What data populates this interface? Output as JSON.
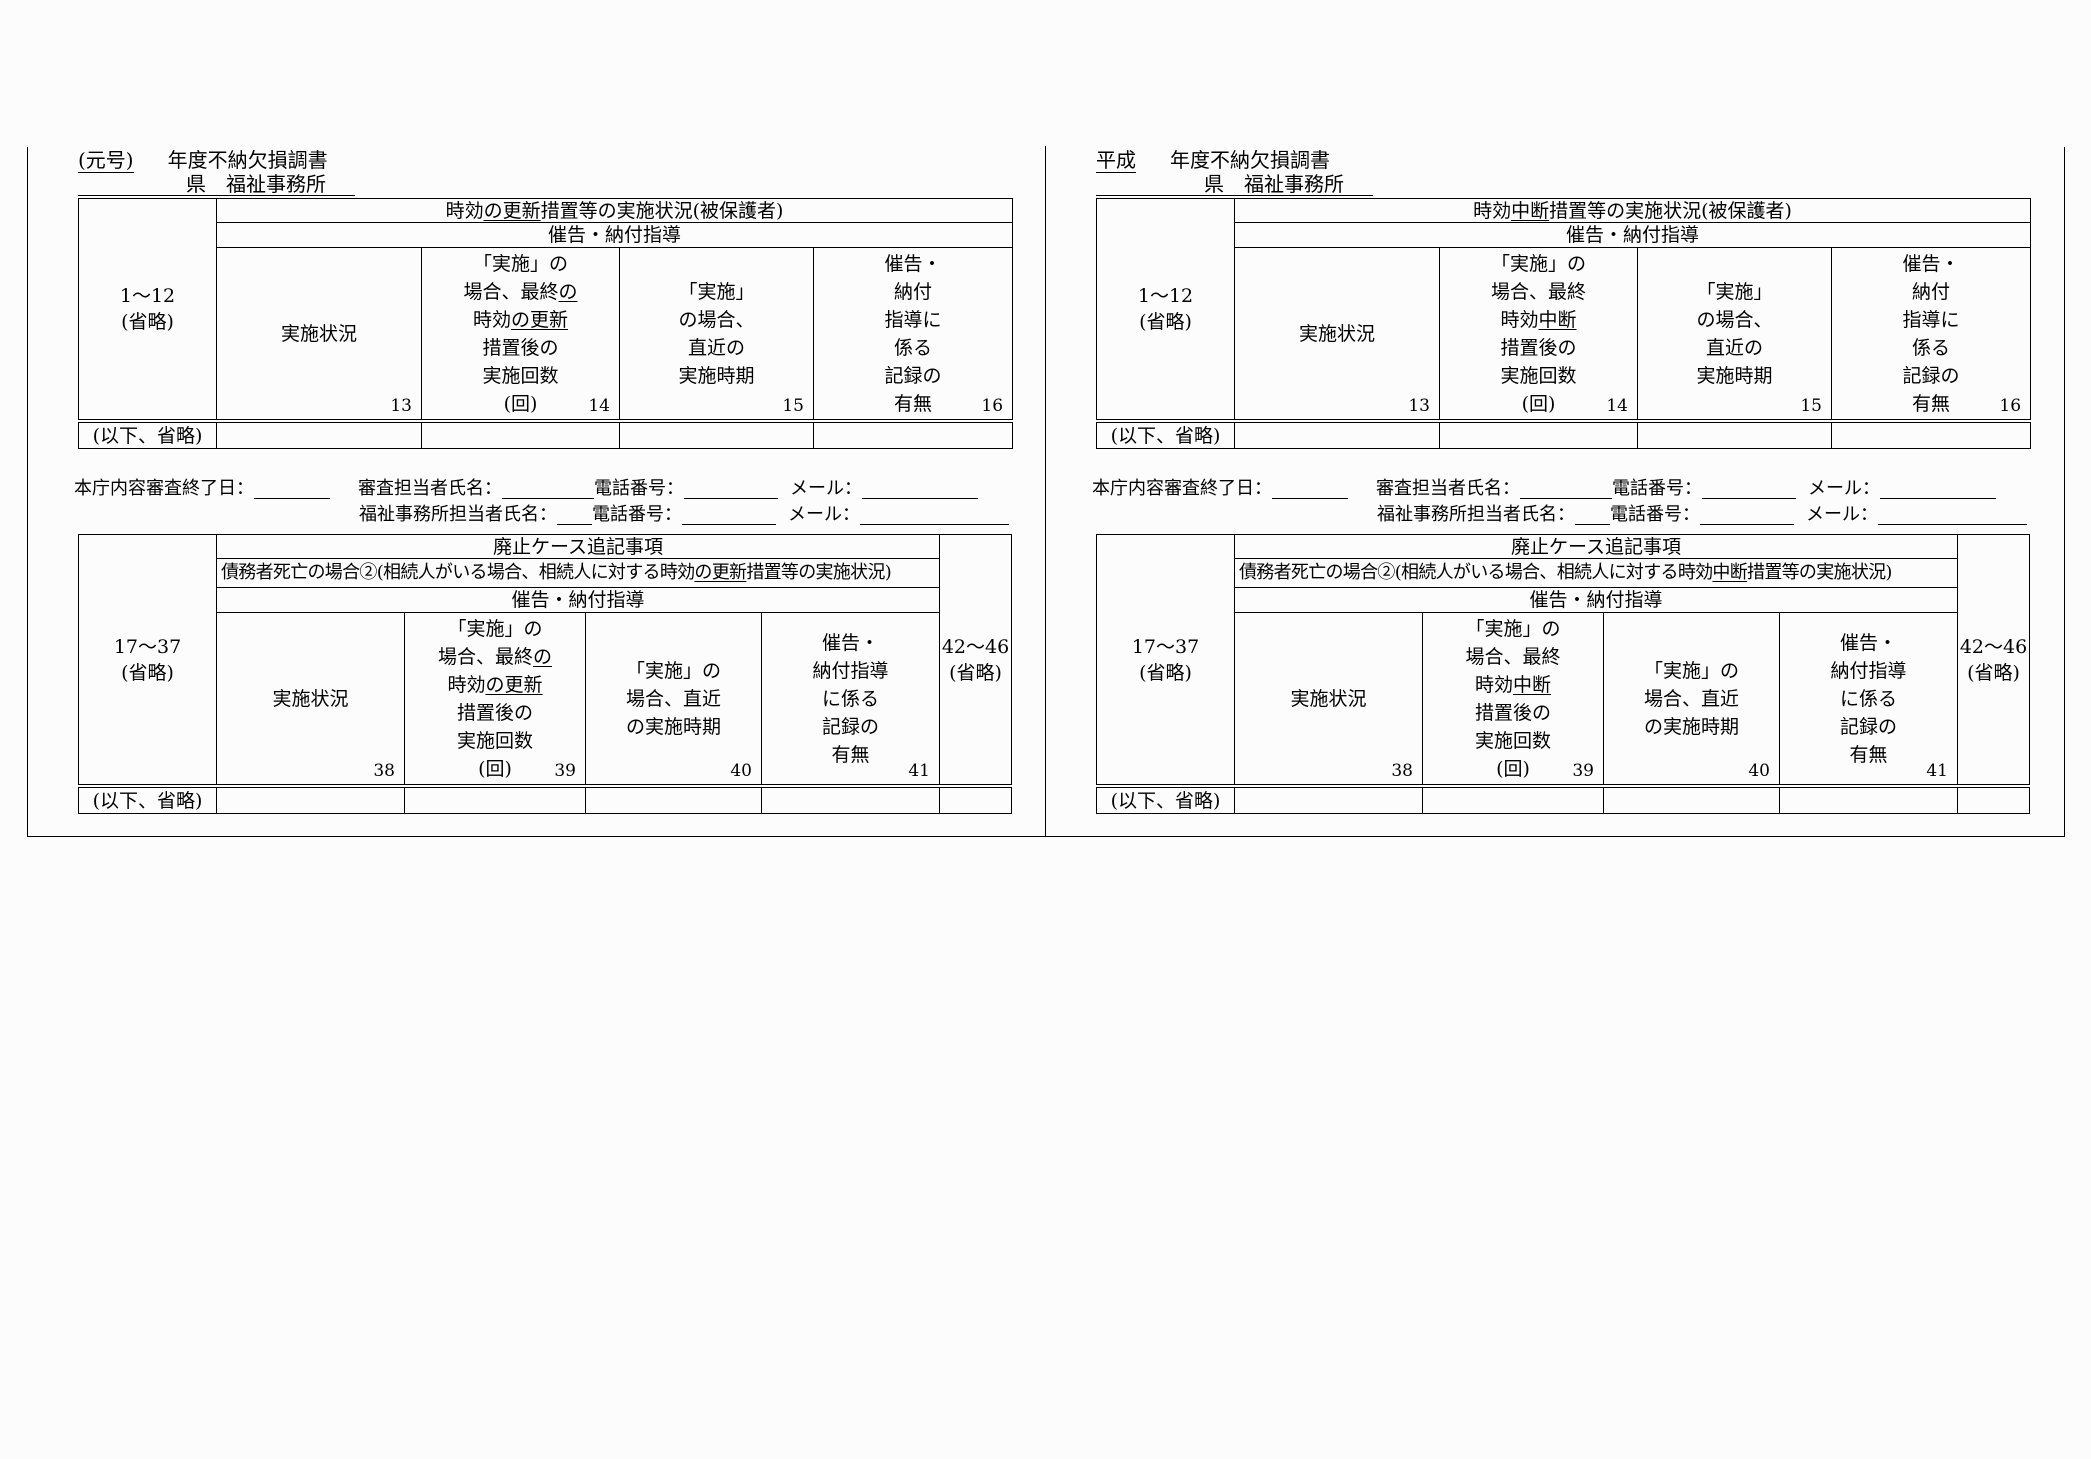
{
  "review": {
    "l1_a": "本庁内容審査終了日：",
    "l1_b": "審査担当者氏名：",
    "l1_c": "電話番号：",
    "l1_d": "メール：",
    "l2_a": "福祉事務所担当者氏名：",
    "l2_b": "電話番号：",
    "l2_c": "メール："
  },
  "panels": [
    {
      "era_label": "(元号)",
      "title_suffix": "年度不納欠損調書",
      "office_line": "県　福祉事務所",
      "table1": {
        "header1": [
          [
            {
              "t": "時効"
            },
            {
              "t": "の更新",
              "u": true
            },
            {
              "t": "措置等の実施状況(被保護者)"
            }
          ]
        ],
        "header2": "催告・納付指導",
        "row_label": [
          [
            {
              "t": "1〜12"
            }
          ],
          [
            {
              "t": "(省略)"
            }
          ]
        ],
        "cols": [
          {
            "num": "13",
            "lines": [
              [
                {
                  "t": "実施状況"
                }
              ]
            ]
          },
          {
            "num": "14",
            "lines": [
              [
                {
                  "t": "「実施」の"
                }
              ],
              [
                {
                  "t": "場合、最終"
                },
                {
                  "t": "の",
                  "u": true
                }
              ],
              [
                {
                  "t": "時効"
                },
                {
                  "t": "の更新",
                  "u": true
                }
              ],
              [
                {
                  "t": "措置後の"
                }
              ],
              [
                {
                  "t": "実施回数"
                }
              ],
              [
                {
                  "t": "(回)"
                }
              ]
            ]
          },
          {
            "num": "15",
            "lines": [
              [
                {
                  "t": "「実施」"
                }
              ],
              [
                {
                  "t": "の場合、"
                }
              ],
              [
                {
                  "t": "直近の"
                }
              ],
              [
                {
                  "t": "実施時期"
                }
              ]
            ]
          },
          {
            "num": "16",
            "lines": [
              [
                {
                  "t": "催告・"
                }
              ],
              [
                {
                  "t": "納付"
                }
              ],
              [
                {
                  "t": "指導に"
                }
              ],
              [
                {
                  "t": "係る"
                }
              ],
              [
                {
                  "t": "記録の"
                }
              ],
              [
                {
                  "t": "有無"
                }
              ]
            ]
          }
        ],
        "bottom_label": "(以下、省略)"
      },
      "table2": {
        "header1": "廃止ケース追記事項",
        "header2": [
          [
            {
              "t": "債務者死亡の場合②(相続人がいる場合、相続人に対する時効"
            },
            {
              "t": "の更新",
              "u": true
            },
            {
              "t": "措置等の実施状況)"
            }
          ]
        ],
        "header3": "催告・納付指導",
        "row_label": [
          [
            {
              "t": "17〜37"
            }
          ],
          [
            {
              "t": "(省略)"
            }
          ]
        ],
        "right_label": [
          [
            {
              "t": "42〜46"
            }
          ],
          [
            {
              "t": "(省略)"
            }
          ]
        ],
        "cols": [
          {
            "num": "38",
            "lines": [
              [
                {
                  "t": "実施状況"
                }
              ]
            ]
          },
          {
            "num": "39",
            "lines": [
              [
                {
                  "t": "「実施」の"
                }
              ],
              [
                {
                  "t": "場合、最終"
                },
                {
                  "t": "の",
                  "u": true
                }
              ],
              [
                {
                  "t": "時効"
                },
                {
                  "t": "の更新",
                  "u": true
                }
              ],
              [
                {
                  "t": "措置後の"
                }
              ],
              [
                {
                  "t": "実施回数"
                }
              ],
              [
                {
                  "t": "(回)"
                }
              ]
            ]
          },
          {
            "num": "40",
            "lines": [
              [
                {
                  "t": "「実施」の"
                }
              ],
              [
                {
                  "t": "場合、直近"
                }
              ],
              [
                {
                  "t": "の実施時期"
                }
              ]
            ]
          },
          {
            "num": "41",
            "lines": [
              [
                {
                  "t": "催告・"
                }
              ],
              [
                {
                  "t": "納付指導"
                }
              ],
              [
                {
                  "t": "に係る"
                }
              ],
              [
                {
                  "t": "記録の"
                }
              ],
              [
                {
                  "t": "有無"
                }
              ]
            ]
          }
        ],
        "bottom_label": "(以下、省略)"
      }
    },
    {
      "era_label": "平成",
      "title_suffix": "年度不納欠損調書",
      "office_line": "県　福祉事務所",
      "table1": {
        "header1": [
          [
            {
              "t": "時効"
            },
            {
              "t": "中断",
              "u": true
            },
            {
              "t": "措置等の実施状況(被保護者)"
            }
          ]
        ],
        "header2": "催告・納付指導",
        "row_label": [
          [
            {
              "t": "1〜12"
            }
          ],
          [
            {
              "t": "(省略)"
            }
          ]
        ],
        "cols": [
          {
            "num": "13",
            "lines": [
              [
                {
                  "t": "実施状況"
                }
              ]
            ]
          },
          {
            "num": "14",
            "lines": [
              [
                {
                  "t": "「実施」の"
                }
              ],
              [
                {
                  "t": "場合、最終"
                }
              ],
              [
                {
                  "t": "時効"
                },
                {
                  "t": "中断",
                  "u": true
                }
              ],
              [
                {
                  "t": "措置後の"
                }
              ],
              [
                {
                  "t": "実施回数"
                }
              ],
              [
                {
                  "t": "(回)"
                }
              ]
            ]
          },
          {
            "num": "15",
            "lines": [
              [
                {
                  "t": "「実施」"
                }
              ],
              [
                {
                  "t": "の場合、"
                }
              ],
              [
                {
                  "t": "直近の"
                }
              ],
              [
                {
                  "t": "実施時期"
                }
              ]
            ]
          },
          {
            "num": "16",
            "lines": [
              [
                {
                  "t": "催告・"
                }
              ],
              [
                {
                  "t": "納付"
                }
              ],
              [
                {
                  "t": "指導に"
                }
              ],
              [
                {
                  "t": "係る"
                }
              ],
              [
                {
                  "t": "記録の"
                }
              ],
              [
                {
                  "t": "有無"
                }
              ]
            ]
          }
        ],
        "bottom_label": "(以下、省略)"
      },
      "table2": {
        "header1": "廃止ケース追記事項",
        "header2": [
          [
            {
              "t": "債務者死亡の場合②(相続人がいる場合、相続人に対する時効"
            },
            {
              "t": "中断",
              "u": true
            },
            {
              "t": "措置等の実施状況)"
            }
          ]
        ],
        "header3": "催告・納付指導",
        "row_label": [
          [
            {
              "t": "17〜37"
            }
          ],
          [
            {
              "t": "(省略)"
            }
          ]
        ],
        "right_label": [
          [
            {
              "t": "42〜46"
            }
          ],
          [
            {
              "t": "(省略)"
            }
          ]
        ],
        "cols": [
          {
            "num": "38",
            "lines": [
              [
                {
                  "t": "実施状況"
                }
              ]
            ]
          },
          {
            "num": "39",
            "lines": [
              [
                {
                  "t": "「実施」の"
                }
              ],
              [
                {
                  "t": "場合、最終"
                }
              ],
              [
                {
                  "t": "時効"
                },
                {
                  "t": "中断",
                  "u": true
                }
              ],
              [
                {
                  "t": "措置後の"
                }
              ],
              [
                {
                  "t": "実施回数"
                }
              ],
              [
                {
                  "t": "(回)"
                }
              ]
            ]
          },
          {
            "num": "40",
            "lines": [
              [
                {
                  "t": "「実施」の"
                }
              ],
              [
                {
                  "t": "場合、直近"
                }
              ],
              [
                {
                  "t": "の実施時期"
                }
              ]
            ]
          },
          {
            "num": "41",
            "lines": [
              [
                {
                  "t": "催告・"
                }
              ],
              [
                {
                  "t": "納付指導"
                }
              ],
              [
                {
                  "t": "に係る"
                }
              ],
              [
                {
                  "t": "記録の"
                }
              ],
              [
                {
                  "t": "有無"
                }
              ]
            ]
          }
        ],
        "bottom_label": "(以下、省略)"
      }
    }
  ]
}
